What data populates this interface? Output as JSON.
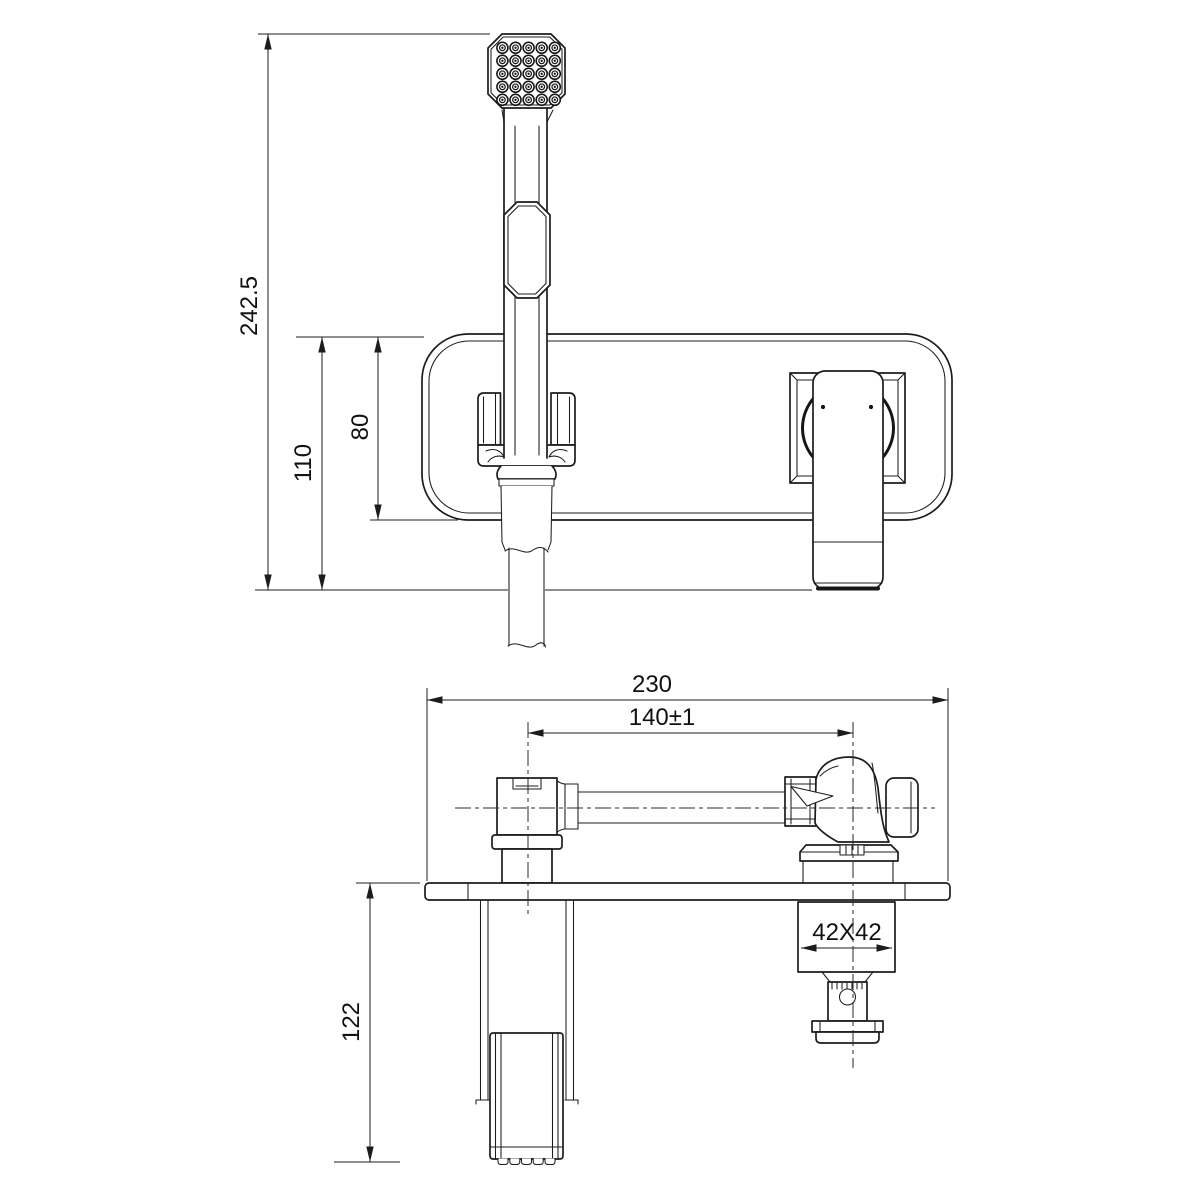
{
  "colors": {
    "line": "#1c1c1c",
    "background": "#ffffff"
  },
  "front_view": {
    "overall_height": "242.5",
    "plate_to_wall_height": "110",
    "plate_height": "80"
  },
  "top_view": {
    "overall_width": "230",
    "center_distance": "140±1",
    "rough_in_box": "42X42",
    "handshower_drop": "122"
  }
}
